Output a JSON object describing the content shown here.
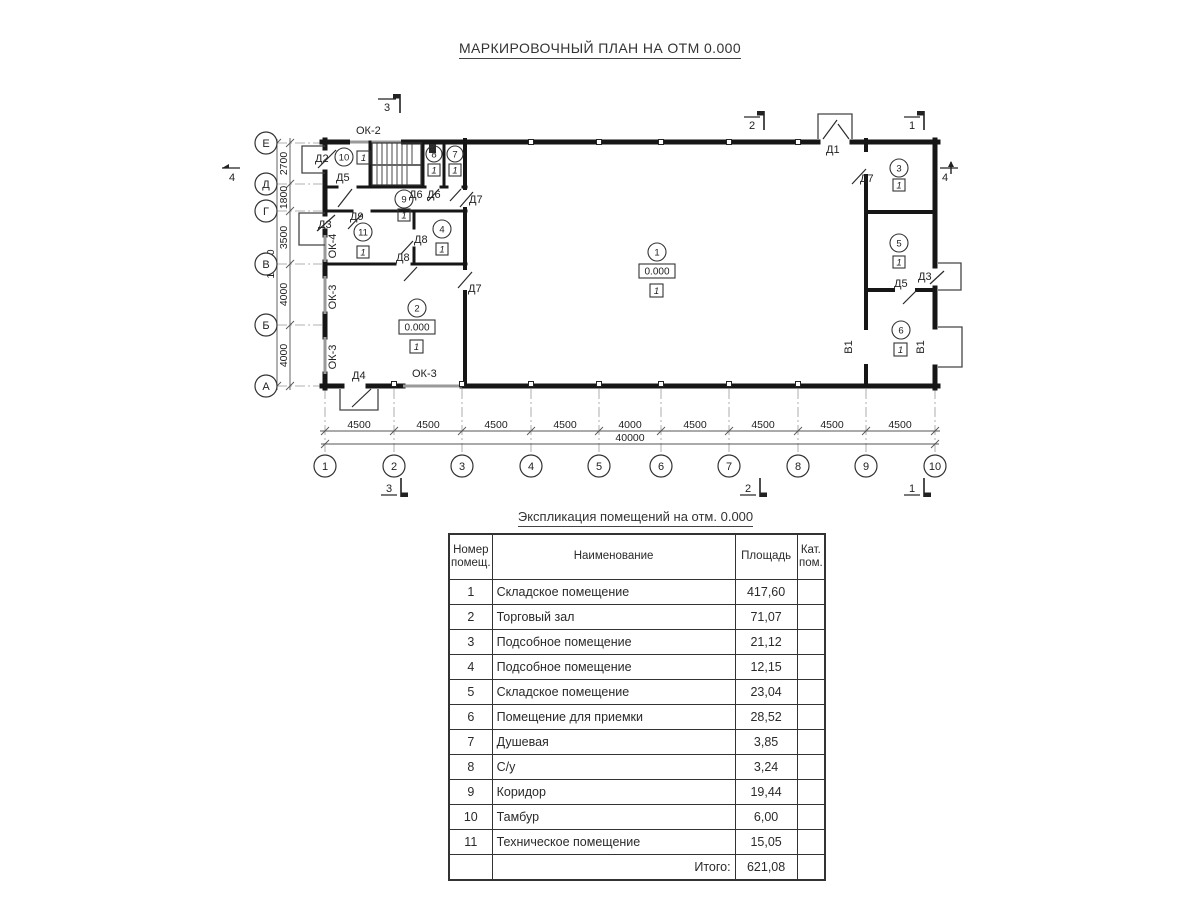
{
  "title": "МАРКИРОВОЧНЫЙ ПЛАН НА ОТМ 0.000",
  "plan": {
    "grid": {
      "row_labels": [
        "Е",
        "Д",
        "Г",
        "В",
        "Б",
        "А"
      ],
      "col_labels": [
        "1",
        "2",
        "3",
        "4",
        "5",
        "6",
        "7",
        "8",
        "9",
        "10"
      ],
      "row_dims": [
        "2700",
        "1800",
        "3500",
        "4000",
        "4000"
      ],
      "row_total": "16000",
      "col_dims": [
        "4500",
        "4500",
        "4500",
        "4500",
        "4000",
        "4500",
        "4500",
        "4500",
        "4500"
      ],
      "col_total": "40000"
    },
    "sections": {
      "s1": "1",
      "s2": "2",
      "s3": "3",
      "s4": "4"
    },
    "doors": {
      "d1": "Д1",
      "d2": "Д2",
      "d3": "Д3",
      "d4": "Д4",
      "d5": "Д5",
      "d6": "Д6",
      "d7": "Д7",
      "d8": "Д8",
      "d9": "Д9"
    },
    "windows": {
      "ok2": "ОК-2",
      "ok3": "ОК-3",
      "ok4": "ОК-4"
    },
    "gates": {
      "v1": "В1"
    },
    "rooms": [
      "1",
      "2",
      "3",
      "4",
      "5",
      "6",
      "7",
      "8",
      "9",
      "10",
      "11"
    ],
    "elevation": "0.000",
    "marker": "1"
  },
  "table": {
    "title": "Экспликация помещений на отм. 0.000",
    "headers": {
      "num": "Номер помещ.",
      "name": "Наименование",
      "area": "Площадь",
      "cat": "Кат. пом."
    },
    "rows": [
      {
        "num": "1",
        "name": "Складское помещение",
        "area": "417,60"
      },
      {
        "num": "2",
        "name": "Торговый зал",
        "area": "71,07"
      },
      {
        "num": "3",
        "name": "Подсобное помещение",
        "area": "21,12"
      },
      {
        "num": "4",
        "name": "Подсобное помещение",
        "area": "12,15"
      },
      {
        "num": "5",
        "name": "Складское помещение",
        "area": "23,04"
      },
      {
        "num": "6",
        "name": "Помещение для приемки",
        "area": "28,52"
      },
      {
        "num": "7",
        "name": "Душевая",
        "area": "3,85"
      },
      {
        "num": "8",
        "name": "С/у",
        "area": "3,24"
      },
      {
        "num": "9",
        "name": "Коридор",
        "area": "19,44"
      },
      {
        "num": "10",
        "name": "Тамбур",
        "area": "6,00"
      },
      {
        "num": "11",
        "name": "Техническое помещение",
        "area": "15,05"
      }
    ],
    "total_label": "Итого:",
    "total_value": "621,08"
  }
}
